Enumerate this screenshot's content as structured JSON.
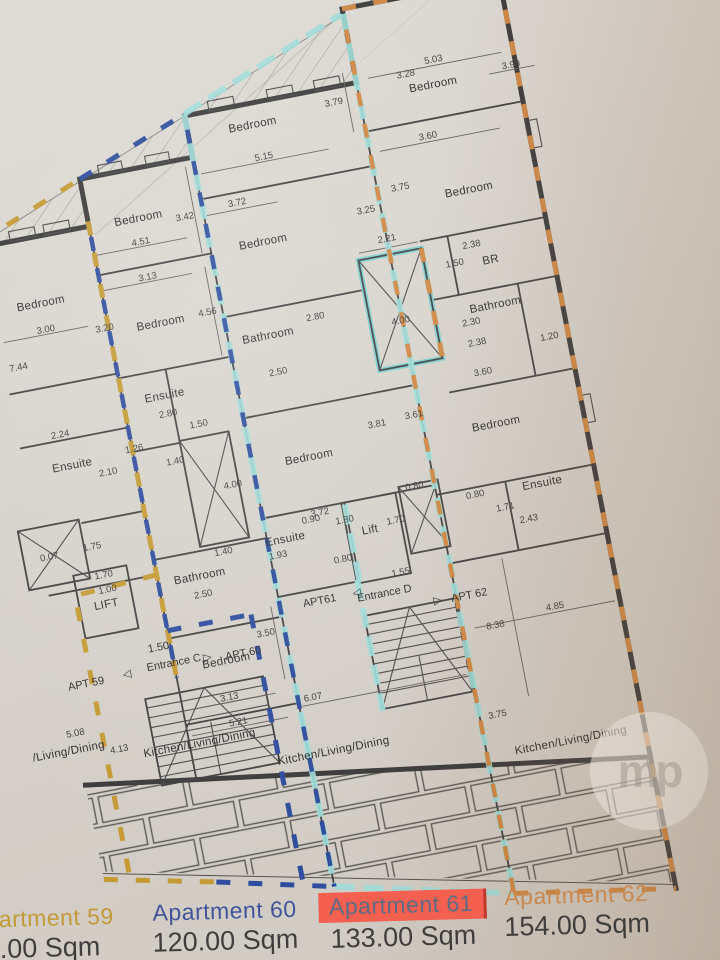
{
  "legend": {
    "items": [
      {
        "label": "Apartment 59",
        "area": "6.00 Sqm",
        "color": "#c49a38",
        "highlight": false
      },
      {
        "label": "Apartment 60",
        "area": "120.00 Sqm",
        "color": "#41549a",
        "highlight": false
      },
      {
        "label": "Apartment 61",
        "area": "133.00 Sqm",
        "color": "#5d6b85",
        "highlight": true
      },
      {
        "label": "Apartment 62",
        "area": "154.00 Sqm",
        "color": "#c9884e",
        "highlight": false
      }
    ],
    "highlight_color": "#f4604f"
  },
  "watermark": {
    "text": "mp"
  },
  "plan": {
    "colors": {
      "apt59_gold": "#c59a33",
      "apt60_blue": "#2e4d9e",
      "apt61_cyan": "#9fdcd8",
      "apt62_orange": "#d08742",
      "core_teal": "#7ccfcf"
    },
    "rooms": [
      {
        "t": "Bedroom",
        "u": -52,
        "v": 170
      },
      {
        "t": "Ensuite",
        "u": -52,
        "v": 335
      },
      {
        "t": "LIFT",
        "u": -45,
        "v": 478
      },
      {
        "t": "/Living/Dining",
        "u": -110,
        "v": 615
      },
      {
        "t": "Bedroom",
        "u": 60,
        "v": 105
      },
      {
        "t": "Bedroom",
        "u": 62,
        "v": 212
      },
      {
        "t": "Ensuite",
        "u": 52,
        "v": 284
      },
      {
        "t": "Bathroom",
        "u": 52,
        "v": 468
      },
      {
        "t": "Bedroom",
        "u": 62,
        "v": 556
      },
      {
        "t": "Kitchen/Living/Dining",
        "u": 20,
        "v": 632
      },
      {
        "t": "Bedroom",
        "u": 190,
        "v": 35
      },
      {
        "t": "Bedroom",
        "u": 178,
        "v": 152
      },
      {
        "t": "Bathroom",
        "u": 165,
        "v": 245
      },
      {
        "t": "Bedroom",
        "u": 182,
        "v": 372
      },
      {
        "t": "Ensuite",
        "u": 143,
        "v": 448
      },
      {
        "t": "Lift",
        "u": 228,
        "v": 455
      },
      {
        "t": "Kitchen/Living/Dining",
        "u": 150,
        "v": 665
      },
      {
        "t": "Bedroom",
        "u": 375,
        "v": 30
      },
      {
        "t": "Bedroom",
        "u": 390,
        "v": 140
      },
      {
        "t": "BR",
        "u": 398,
        "v": 213
      },
      {
        "t": "Bathroom",
        "u": 394,
        "v": 258
      },
      {
        "t": "Bedroom",
        "u": 372,
        "v": 375
      },
      {
        "t": "Ensuite",
        "u": 406,
        "v": 442
      },
      {
        "t": "Kitchen/Living/Dining",
        "u": 385,
        "v": 700
      }
    ],
    "dims": [
      {
        "t": "3.90",
        "u": 455,
        "v": 25
      },
      {
        "t": "7.44",
        "u": -86,
        "v": 228
      },
      {
        "t": "3.00",
        "u": -52,
        "v": 196
      },
      {
        "t": "2.24",
        "u": -58,
        "v": 302
      },
      {
        "t": "2.10",
        "u": -18,
        "v": 348
      },
      {
        "t": "0.07",
        "u": -92,
        "v": 420
      },
      {
        "t": "1.75",
        "u": -48,
        "v": 418
      },
      {
        "t": "1.70",
        "u": -42,
        "v": 448
      },
      {
        "t": "1.00",
        "u": -41,
        "v": 463
      },
      {
        "t": "5.08",
        "u": -100,
        "v": 598
      },
      {
        "t": "4.13",
        "u": -60,
        "v": 622
      },
      {
        "t": "4.51",
        "u": 58,
        "v": 128
      },
      {
        "t": "3.42",
        "u": 106,
        "v": 112
      },
      {
        "t": "3.13",
        "u": 58,
        "v": 164
      },
      {
        "t": "3.20",
        "u": 6,
        "v": 206
      },
      {
        "t": "4.56",
        "u": 110,
        "v": 210
      },
      {
        "t": "2.80",
        "u": 52,
        "v": 302
      },
      {
        "t": "1.26",
        "u": 12,
        "v": 330
      },
      {
        "t": "1.50",
        "u": 80,
        "v": 318
      },
      {
        "t": "1.40",
        "u": 50,
        "v": 350
      },
      {
        "t": "4.00",
        "u": 102,
        "v": 384
      },
      {
        "t": "1.40",
        "u": 80,
        "v": 448
      },
      {
        "t": "2.50",
        "u": 52,
        "v": 486
      },
      {
        "t": "3.50",
        "u": 106,
        "v": 536
      },
      {
        "t": "3.13",
        "u": 58,
        "v": 592
      },
      {
        "t": "5.21",
        "u": 62,
        "v": 618
      },
      {
        "t": "6.07",
        "u": 140,
        "v": 608
      },
      {
        "t": "5.15",
        "u": 195,
        "v": 68
      },
      {
        "t": "3.79",
        "u": 274,
        "v": 28
      },
      {
        "t": "3.72",
        "u": 160,
        "v": 108
      },
      {
        "t": "3.25",
        "u": 285,
        "v": 140
      },
      {
        "t": "2.80",
        "u": 215,
        "v": 235
      },
      {
        "t": "2.50",
        "u": 168,
        "v": 282
      },
      {
        "t": "2.21",
        "u": 300,
        "v": 172
      },
      {
        "t": "4.00",
        "u": 298,
        "v": 255
      },
      {
        "t": "3.81",
        "u": 255,
        "v": 352
      },
      {
        "t": "3.61",
        "u": 293,
        "v": 350
      },
      {
        "t": "3.72",
        "u": 182,
        "v": 428
      },
      {
        "t": "1.93",
        "u": 133,
        "v": 462
      },
      {
        "t": "0.90",
        "u": 172,
        "v": 433
      },
      {
        "t": "1.80",
        "u": 205,
        "v": 440
      },
      {
        "t": "1.70",
        "u": 255,
        "v": 450
      },
      {
        "t": "0.80",
        "u": 280,
        "v": 420
      },
      {
        "t": "0.80",
        "u": 196,
        "v": 478
      },
      {
        "t": "1.55",
        "u": 250,
        "v": 502
      },
      {
        "t": "5.03",
        "u": 380,
        "v": 5
      },
      {
        "t": "3.28",
        "u": 350,
        "v": 14
      },
      {
        "t": "3.60",
        "u": 360,
        "v": 79
      },
      {
        "t": "3.75",
        "u": 323,
        "v": 124
      },
      {
        "t": "2.38",
        "u": 382,
        "v": 194
      },
      {
        "t": "1.50",
        "u": 362,
        "v": 209
      },
      {
        "t": "2.30",
        "u": 367,
        "v": 270
      },
      {
        "t": "2.38",
        "u": 369,
        "v": 291
      },
      {
        "t": "1.20",
        "u": 441,
        "v": 299
      },
      {
        "t": "3.60",
        "u": 369,
        "v": 321
      },
      {
        "t": "0.80",
        "u": 338,
        "v": 440
      },
      {
        "t": "1.71",
        "u": 365,
        "v": 458
      },
      {
        "t": "2.43",
        "u": 386,
        "v": 474
      },
      {
        "t": "4.85",
        "u": 395,
        "v": 565
      },
      {
        "t": "8.38",
        "u": 333,
        "v": 572
      },
      {
        "t": "3.75",
        "u": 318,
        "v": 660
      }
    ],
    "markers": [
      {
        "t": "APT 59",
        "u": -80,
        "v": 552
      },
      {
        "t": "◁",
        "u": -38,
        "v": 550
      },
      {
        "t": "1.50",
        "u": -2,
        "v": 530,
        "fs": 9.5
      },
      {
        "t": "Entrance C",
        "u": 10,
        "v": 548
      },
      {
        "t": "▷",
        "u": 44,
        "v": 549
      },
      {
        "t": "APT 60",
        "u": 80,
        "v": 552
      },
      {
        "t": "APT61",
        "u": 165,
        "v": 515
      },
      {
        "t": "◁",
        "u": 203,
        "v": 514
      },
      {
        "t": "Entrance D",
        "u": 230,
        "v": 520
      },
      {
        "t": "▷",
        "u": 281,
        "v": 537
      },
      {
        "t": "APT 62",
        "u": 313,
        "v": 538
      }
    ]
  }
}
